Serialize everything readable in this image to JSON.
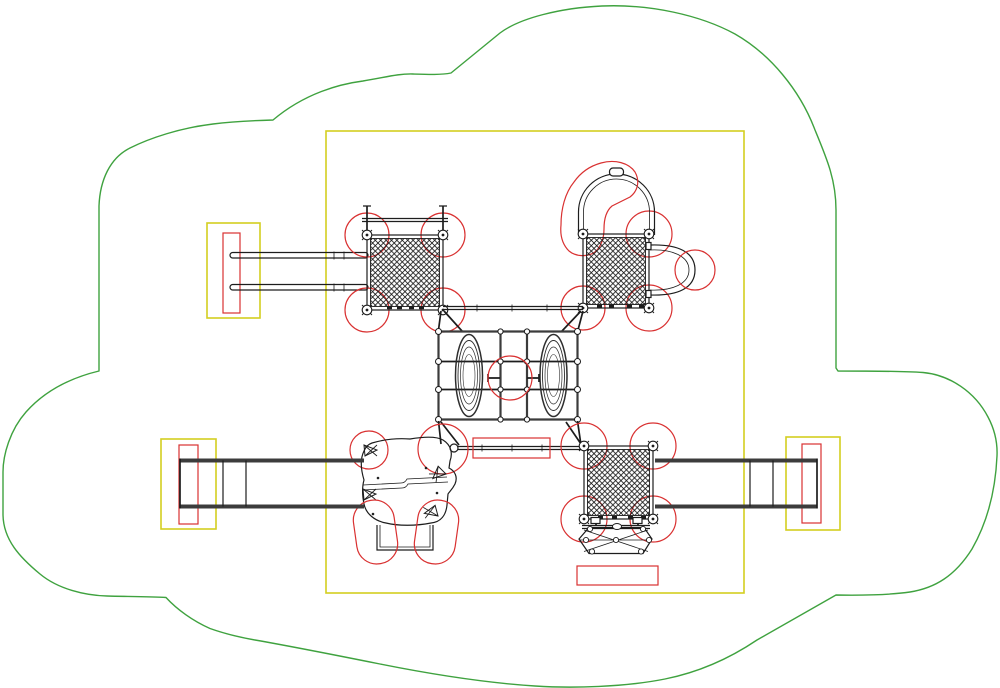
{
  "colors": {
    "green": "#3fa23f",
    "yellow": "#d4ce20",
    "red": "#d93131",
    "ink": "#1d1d1d",
    "steel": "#3c3c3c",
    "bg": "#ffffff"
  },
  "shapes": {
    "use_zone_cloud": "M 99,206 C 100,180 110,158 130,148 C 150,138 180,128 213,124 C 233,121.5 255,120.5 273,120 C 305,93 340,84 363,81 C 385,77.5 398,73.5 413,74 C 428,74.5 441,75 451,73 L 500,33 C 520,18 560,8 602,6 C 650,4 700,15 735,34 C 770,54 800,90 815,130 C 827,159 836,180 836,210 L 836,368 L 838,371 C 865,371 900,371 923,372.5 C 950,375 975,392 988,417 C 996,432 997.5,445 997,456 C 995.5,490 988,521 972,549 C 955,576 935,588 910,592 C 890,595 858,595.5 836,595 L 757,640 C 731,657.5 700,672 665,679 C 625,687 572,688.5 535,686 C 480,682.5 420,672 380,664 C 340,656 295,647 255,640 C 238,637 224,633.5 210,628.5 C 193,621 177,609.5 166,597.5 C 150,596.5 124,596.5 107,596 C 85,595.5 58,589 40,574 C 20,557.5 3.5,540 3,515 L 3,472 C 3,455 10,430 26,412 C 46,389.5 72,377.5 99,371 Z",
    "arch_guard_zone": "M 601,163 C 615,159 629,163 635,172 C 640,181 638,191 630,197 L 612,206 C 606,211 604,219 604,229 C 604,238 601,247 595,252 C 588,257 576,257 569,251 C 562,244 560,235 561,225 C 561,209 565,193 574,182 C 581,172 590,166 601,163 Z",
    "boulder_outline": "M 372,443 C 382,440 396,438 410,439 C 422,437 436,436 443,440 C 451,445 453,453 450,461 L 449,468 C 455,471 458,477 455,484 C 452,490 449,492 448,494 L 447,505 C 446,515 441,522 431,523 C 416,526 398,526 386,523 C 375,521 366,514 364,504 C 362,494 362,487 364,480 C 361,470 360,459 364,451 C 366,446 369,444 372,443 Z",
    "boulder_crease_a": "M 363,485 L 401,483 C 404,483 406,481 407,479 L 447,477",
    "boulder_crease_b": "M 363,490 L 402,488 C 405,488 407,486 408,484 L 448,482",
    "hex_outline": "M 579,539 L 589,527.5 L 644,527.5 L 652,539 L 643,553.5 L 589,553.5 Z"
  }
}
